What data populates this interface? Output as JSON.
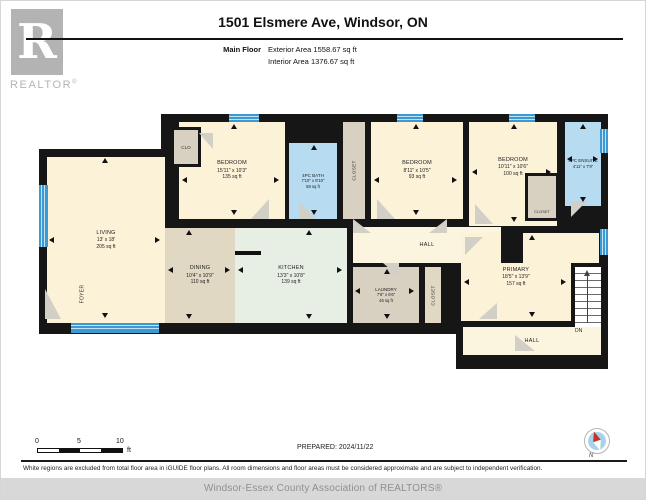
{
  "header": {
    "title": "1501 Elsmere Ave, Windsor, ON",
    "floor_label": "Main Floor",
    "exterior_area": "Exterior Area 1558.67 sq ft",
    "interior_area": "Interior Area 1376.67 sq ft",
    "logo_letter": "R",
    "logo_word": "REALTOR",
    "logo_reg": "®"
  },
  "rooms": {
    "living": {
      "name": "LIVING",
      "dims": "13' x 18'",
      "area": "205 sq ft"
    },
    "foyer": {
      "name": "FOYER"
    },
    "clo": {
      "name": "CLO"
    },
    "bedroom1": {
      "name": "BEDROOM",
      "dims": "15'11\" x 10'3\"",
      "area": "135 sq ft"
    },
    "bath": {
      "name": "4PC BATH",
      "dims": "7'10\" x 8'10\"",
      "area": "58 sq ft"
    },
    "closet_bath": {
      "name": "CLOSET"
    },
    "bedroom2": {
      "name": "BEDROOM",
      "dims": "8'11\" x 10'5\"",
      "area": "93 sq ft"
    },
    "bedroom3": {
      "name": "BEDROOM",
      "dims": "10'11\" x 10'6\"",
      "area": "100 sq ft"
    },
    "closet_bed3": {
      "name": "CLOSET"
    },
    "ensuite": {
      "name": "4PC ENSUITE",
      "dims": "4'11\" x 7'9\""
    },
    "hall": {
      "name": "HALL"
    },
    "dining": {
      "name": "DINING",
      "dims": "10'4\" x 10'9\"",
      "area": "110 sq ft"
    },
    "kitchen": {
      "name": "KITCHEN",
      "dims": "13'3\" x 10'8\"",
      "area": "139 sq ft"
    },
    "laundry": {
      "name": "LAUNDRY",
      "dims": "7'6\" x 6'6\"",
      "area": "46 sq ft"
    },
    "closet_laundry": {
      "name": "CLOSET"
    },
    "primary": {
      "name": "PRIMARY",
      "dims": "18'5\" x 13'9\"",
      "area": "157 sq ft"
    },
    "hall_bottom": {
      "name": "HALL"
    },
    "stairs_label": "DN"
  },
  "scale_bar": {
    "tick0": "0",
    "tick5": "5",
    "tick10": "10",
    "unit": "ft"
  },
  "prepared": "PREPARED: 2024/11/22",
  "compass": {
    "label": "N"
  },
  "disclaimer": "White regions are excluded from total floor area in iGUIDE floor plans. All room dimensions and floor areas must be considered approximate and are subject to independent verification.",
  "footer": "Windsor-Essex County Association of REALTORS®",
  "palette": {
    "wall": "#161616",
    "cream": "#fcf2d7",
    "hallcream": "#fbf4de",
    "tan": "#e1d8c4",
    "closet_tan": "#d8d0c1",
    "mint": "#e7efe5",
    "bath_blue": "#b7dbf1",
    "window_blue": "#3e99d2",
    "window_stripe": "#bfe3f5",
    "door_gray": "#d2cfc6",
    "logo_gray": "#b3b3b3",
    "footer_bg": "#d8d8d8",
    "footer_text": "#8f8f8f",
    "stair": "#ffffff"
  }
}
